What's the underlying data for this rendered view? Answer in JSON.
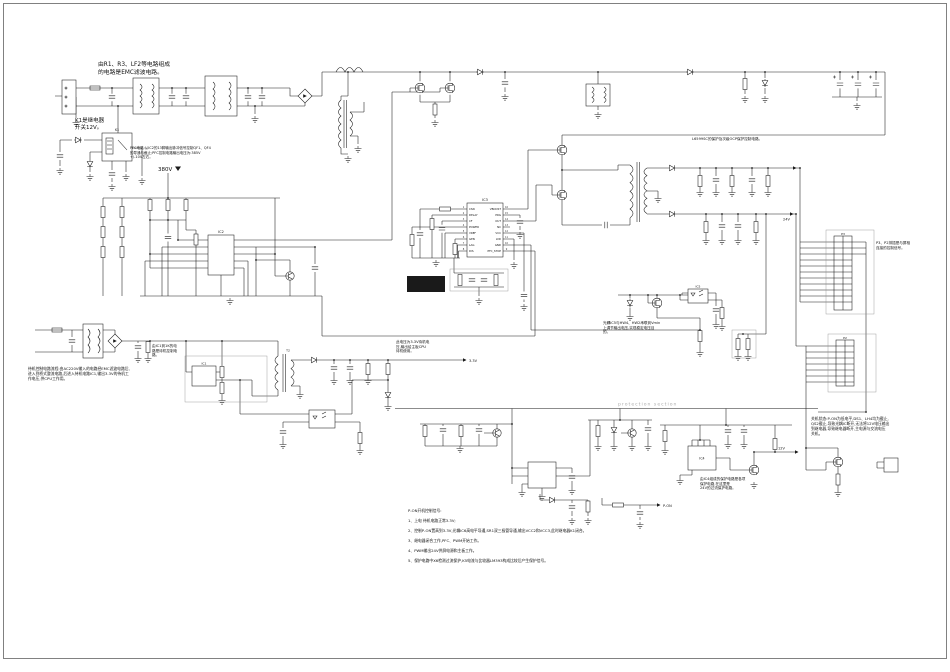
{
  "colors": {
    "bg": "#ffffff",
    "line": "#1a1a1a",
    "muted_line": "#8a8a8a",
    "text": "#111111",
    "muted_text": "#adadad",
    "redacted": "#0b0b0b"
  },
  "annotations": {
    "emc": "由R1、R3、LF2等电路组成\n的电路是EMC滤波电路。",
    "k1": "K1是继电器\n开关12V。",
    "pfc": "PFC电路:从IC2的13脚输出脉冲信号控制QF1、QF4\n的导通与截止;PFC控制电路输出电压为:385V\n+/-10V左右。",
    "ocp": "L6599SC的保护及次级OCP保护控制电路。",
    "panel_conn": "P3、P2排插是与屏相\n连接的控制信号。",
    "opto_fb": "光耦IC5与HW4、HW2串联到Vmin\n上调节输出电压,实现稳定电压目\n的。",
    "standby_ic": "由IC1到1K的电\n路是待机控制电\n路。",
    "standby_out": "此电压为3.3V待机电\n压,输出给主板CPU\n待机使用。",
    "standby_flow": "待机控制电路流程:由AC220V输入的电路经EMC滤波电路后,\n进入到桥式整流电路,后进入待机电路IC1,输出3.3V的待机工\n作电压,供CPU工作用。",
    "power_off": "关机状态:P-ON为低电平,DS1、LH4均为截止,\nQS2截止,导致光耦IC断开,无法将12V电压输出\n到继电器,导致继电器断开,主电源与交流电压\n关机。",
    "prot_24v": "由IC4组成的保护电路是各项\n保护电路,在这里是\n24V的过流保护电路。",
    "pon": {
      "title": "P-ON开机控制信号:",
      "items": [
        "1、上电 待机电路正常3.3V;",
        "2、控制P-ON置高到3.3V,光耦IC6高电平导通,SR1双三极管导通,输出VCC2和VCC3,此时继电器K1闭合。",
        "3、继电器闭合工作,PFC、PWM开始工作。",
        "4、PWM输出24V供屏电源和主板工作。",
        "5、保护电路中X6检测过流保护,K5电流与比较器LM393构成比较后产生保护信号。"
      ]
    }
  },
  "labels": {
    "v380": "380V",
    "v24": "24V",
    "v3_3": "3.3V",
    "v12": "12V",
    "p_on": "P-ON",
    "protection": "protection section"
  },
  "refs": {
    "ic1": "IC1",
    "ic2": "IC2",
    "ic3": "IC3",
    "ic4": "IC4",
    "ic5": "IC5",
    "t2": "T2",
    "k1": "K1",
    "p3": "P3",
    "p2": "P2"
  },
  "ic3": {
    "left_names": [
      "CSN",
      "DELAY",
      "CF",
      "POWER",
      "VREF",
      "GEN",
      "LAG",
      "DIS"
    ],
    "right_names": [
      "VBOOST",
      "PRG",
      "OUT",
      "NC",
      "VCC",
      "LVD",
      "GND",
      "PFC_STOP"
    ],
    "left_nums": [
      "1",
      "2",
      "3",
      "4",
      "5",
      "6",
      "7",
      "8"
    ],
    "right_nums": [
      "16",
      "15",
      "14",
      "13",
      "12",
      "11",
      "10",
      "9"
    ]
  }
}
